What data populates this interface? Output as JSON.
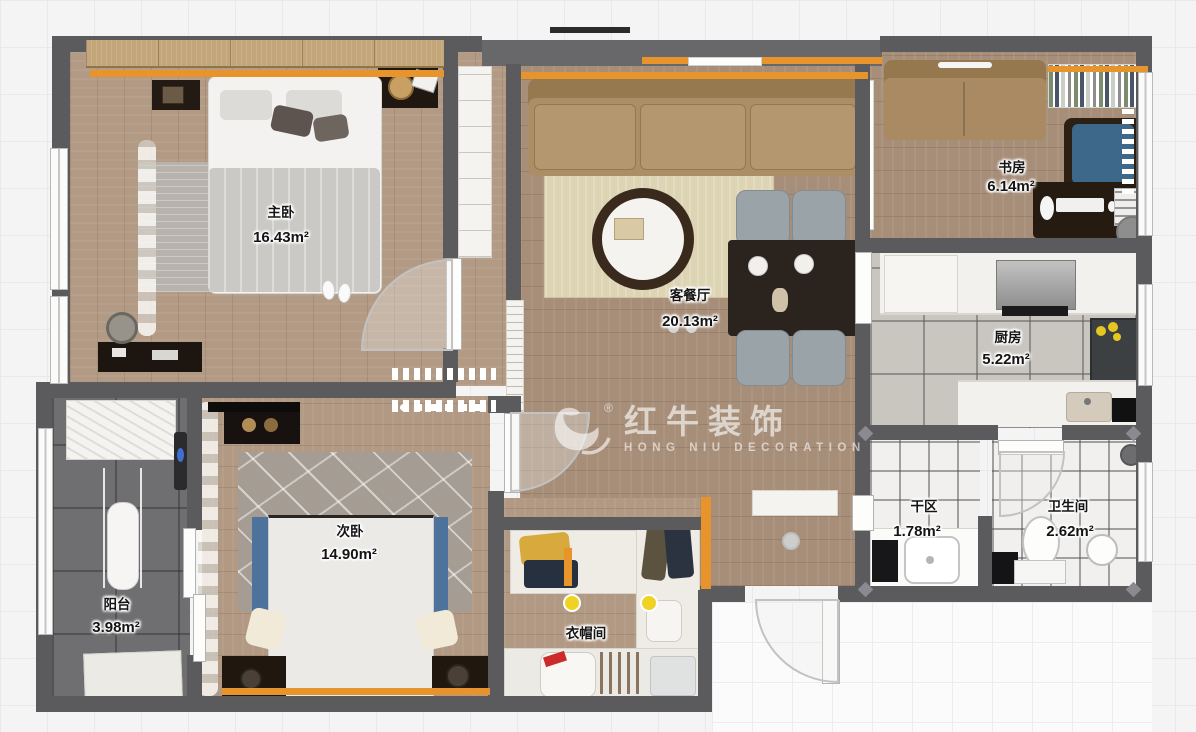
{
  "watermark": {
    "brand": "红牛装饰",
    "subtitle": "HONG NIU DECORATION",
    "registered": "®"
  },
  "rooms": {
    "master": {
      "label": "主卧",
      "area": "16.43m²"
    },
    "living": {
      "label": "客餐厅",
      "area": "20.13m²"
    },
    "study": {
      "label": "书房",
      "area": "6.14m²"
    },
    "kitchen": {
      "label": "厨房",
      "area": "5.22m²"
    },
    "dry": {
      "label": "干区",
      "area": "1.78m²"
    },
    "bath": {
      "label": "卫生间",
      "area": "2.62m²"
    },
    "bedroom2": {
      "label": "次卧",
      "area": "14.90m²"
    },
    "balcony": {
      "label": "阳台",
      "area": "3.98m²"
    },
    "cloakroom": {
      "label": "衣帽间",
      "area": ""
    }
  },
  "palette": {
    "wall": "#5b5b5d",
    "accent_orange": "#e8942d",
    "wood": "#b39a84",
    "kitchen_tile": "#c9c6c0",
    "bath_tile": "#f1f0ee",
    "balcony_tile": "#6f6f71",
    "sofa_brown": "#a98c68",
    "bed_blue": "#4d739c",
    "study_blue": "#3d6889",
    "light_yellow": "#f0d223"
  }
}
